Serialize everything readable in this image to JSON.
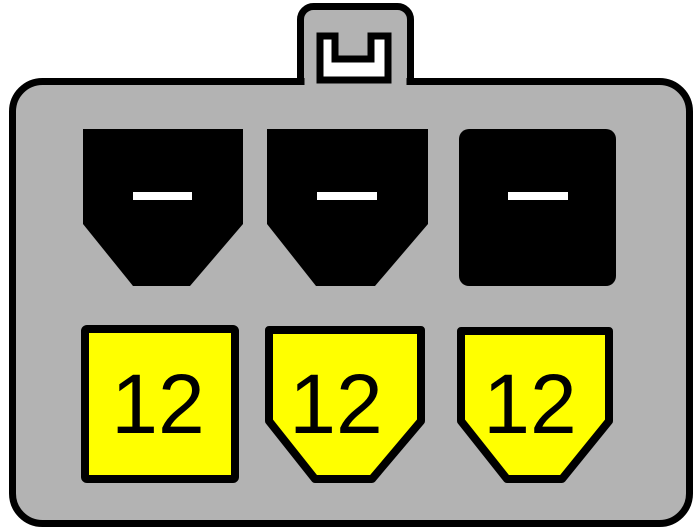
{
  "diagram": {
    "type": "connector-pinout",
    "colors": {
      "background": "#ffffff",
      "body_fill": "#b3b3b3",
      "outline": "#000000",
      "ground_pin_fill": "#000000",
      "dash_mark_fill": "#ffffff",
      "latch_slot_fill": "#ffffff",
      "power_pin_fill": "#ffff00",
      "label_color": "#000000"
    },
    "top_row_pins": [
      {
        "mark": "white-dash"
      },
      {
        "mark": "white-dash"
      },
      {
        "mark": "white-dash"
      }
    ],
    "bottom_row_pins": [
      {
        "label": "12"
      },
      {
        "label": "12"
      },
      {
        "label": "12"
      }
    ]
  }
}
